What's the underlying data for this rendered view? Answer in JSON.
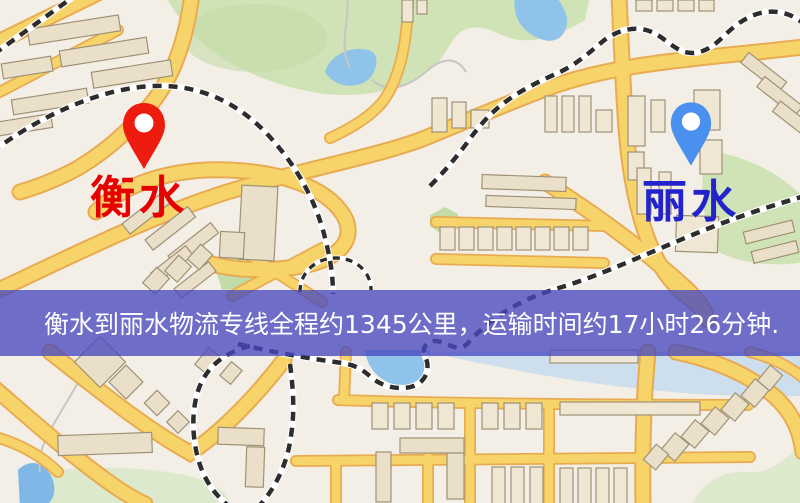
{
  "map": {
    "origin_label": "衡水",
    "destination_label": "丽水",
    "origin_pin_icon": "red-location-pin-icon",
    "destination_pin_icon": "blue-location-pin-icon"
  },
  "banner": {
    "text": "衡水到丽水物流专线全程约1345公里，运输时间约17小时26分钟."
  },
  "colors": {
    "map-bg": "#f4efe6",
    "road-fill": "#f7d469",
    "road-casing": "#e8ab52",
    "building-fill": "#eae0ca",
    "building-stroke": "#9f9176",
    "park": "#cfe3b6",
    "water": "#8fc3ea",
    "rail-dark": "#2d2d2d",
    "banner-bg": "rgba(72,72,190,0.78)",
    "banner-text": "#ffffff",
    "origin-pin": "#ee1c0f",
    "dest-pin": "#4a90ee",
    "origin-label": "#e60000",
    "dest-label": "#2323cc"
  }
}
